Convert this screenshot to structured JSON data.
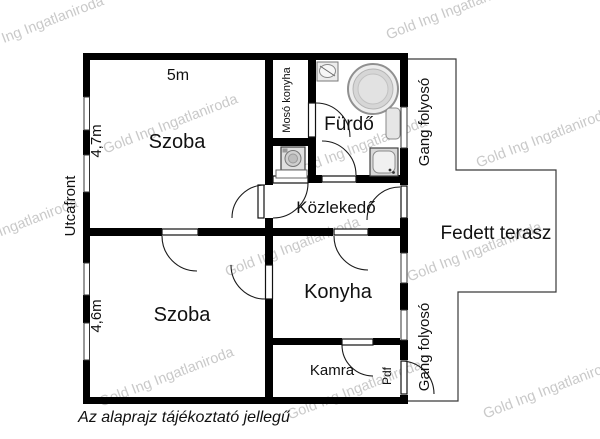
{
  "rooms": {
    "szoba_felso": "Szoba",
    "szoba_also": "Szoba",
    "moso_konyha": "Mosó konyha",
    "furdo": "Fürdő",
    "kozlekedo": "Közlekedő",
    "konyha": "Konyha",
    "kamra": "Kamra",
    "fedett_terasz": "Fedett terasz",
    "gang_folyoso_felso": "Gang folyosó",
    "gang_folyoso_also": "Gang folyosó",
    "pdf": "Pdf"
  },
  "dimensions": {
    "szoba_felso_szelesseg": "5m",
    "szoba_felso_hossz": "4,7m",
    "szoba_also_hossz": "4,6m"
  },
  "annotations": {
    "utcafront": "Utcafront",
    "caption": "Az alaprajz tájékoztató jellegű"
  },
  "watermark": {
    "text": "Gold Ing Ingatlaniroda",
    "color": "#c9c9c9"
  },
  "colors": {
    "walls": "#000000",
    "background": "#ffffff",
    "thin_lines": "#3a3a3a",
    "fixture_fill": "#e0e0e0"
  }
}
